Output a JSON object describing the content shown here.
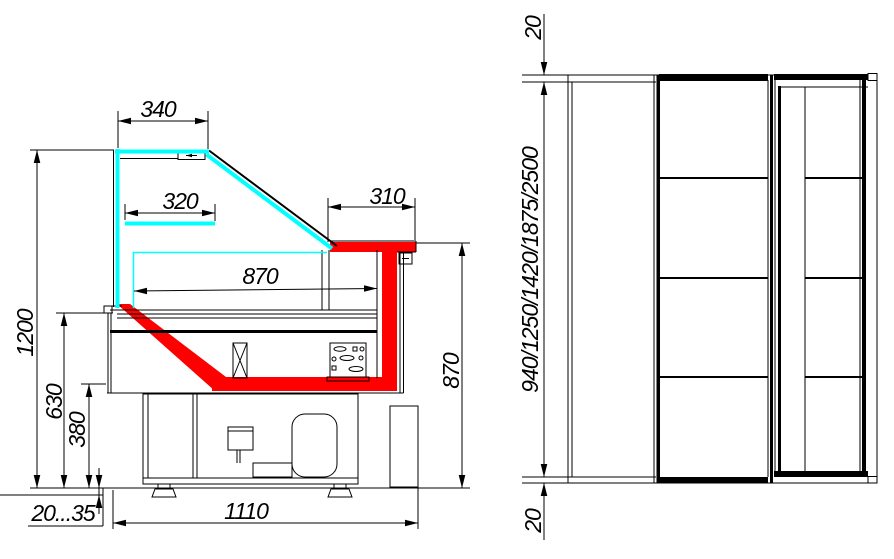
{
  "drawing": {
    "colors": {
      "background": "#ffffff",
      "line": "#000000",
      "glass": "#00ffff",
      "highlight": "#ff0000"
    },
    "side_view": {
      "dim_canopy_top": "340",
      "dim_shelf": "320",
      "dim_counter": "310",
      "dim_display_depth": "870",
      "dim_overall_height": "1200",
      "dim_front_height": "630",
      "dim_well_height": "380",
      "dim_leg_adjust": "20...35",
      "dim_overall_depth": "1110",
      "dim_counter_height": "870"
    },
    "end_view": {
      "dim_top_overhang": "20",
      "dim_lengths": "940/1250/1420/1875/2500",
      "dim_bottom_overhang": "20"
    }
  }
}
